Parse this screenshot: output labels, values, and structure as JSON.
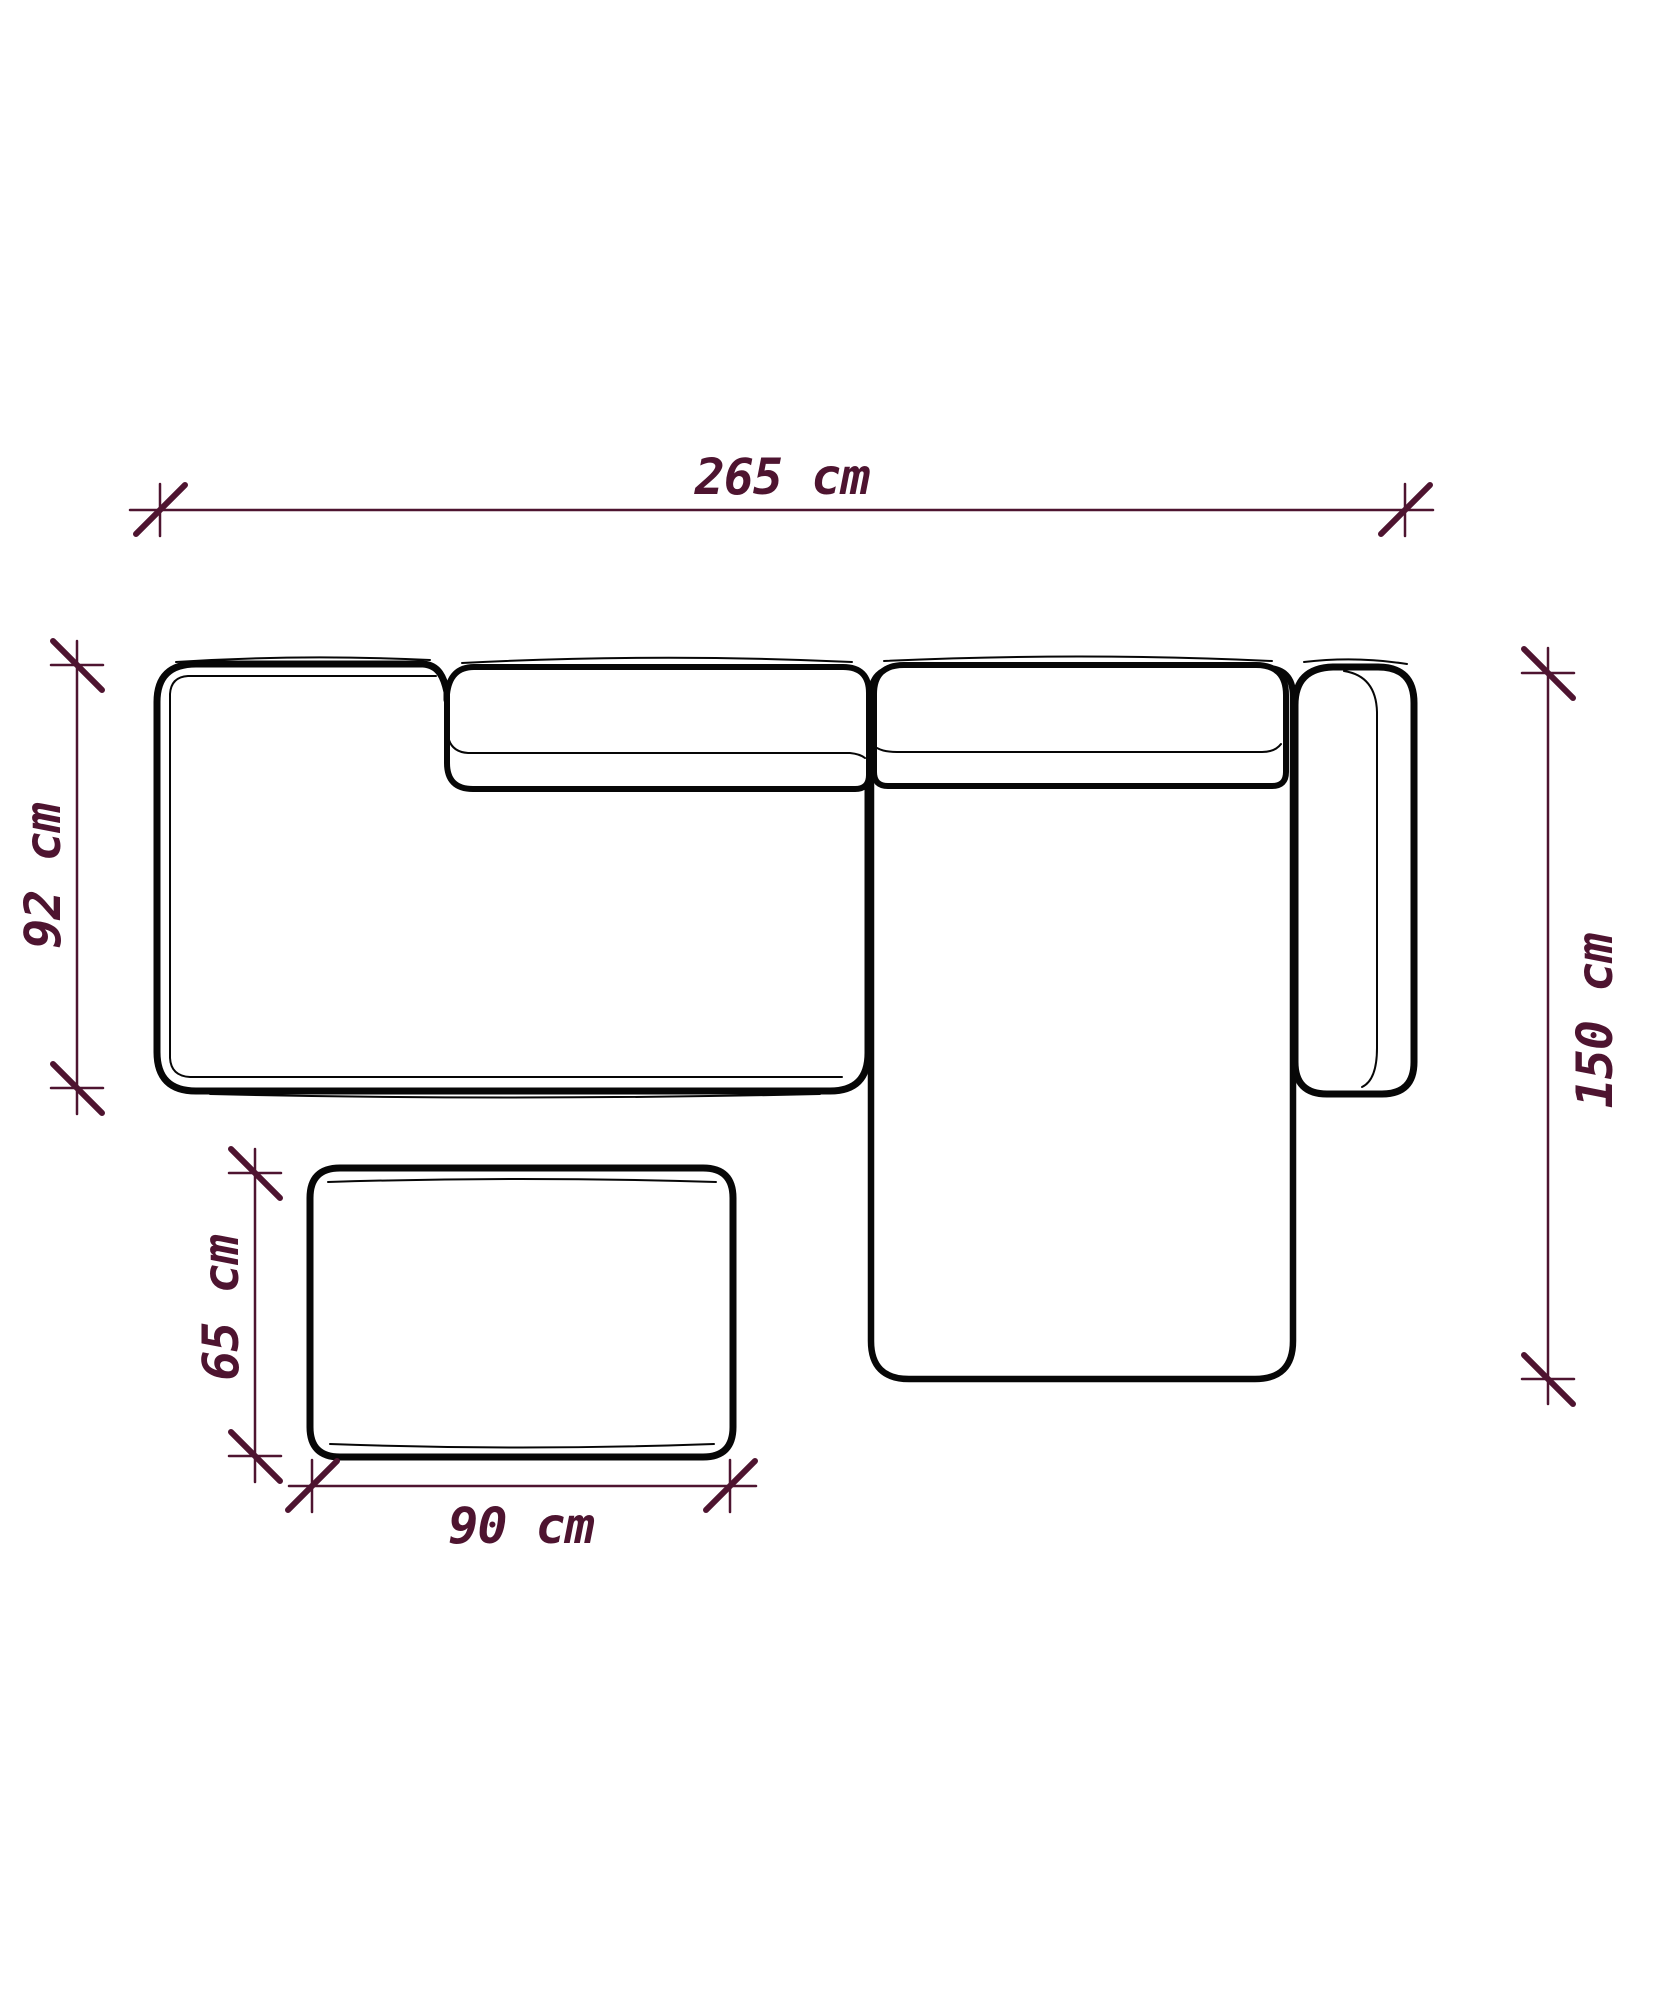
{
  "diagram_title": "sofa-top-view-dimension-drawing",
  "unit": "cm",
  "colors": {
    "dimension": "#4e1430",
    "outline": "#070707",
    "background": "#ffffff"
  },
  "dimensions": {
    "overall_width": {
      "label": "265 cm",
      "value": 265
    },
    "left_depth": {
      "label": "92 cm",
      "value": 92
    },
    "chaise_depth": {
      "label": "150 cm",
      "value": 150
    },
    "ottoman_depth": {
      "label": "65 cm",
      "value": 65
    },
    "ottoman_width": {
      "label": "90 cm",
      "value": 90
    }
  }
}
